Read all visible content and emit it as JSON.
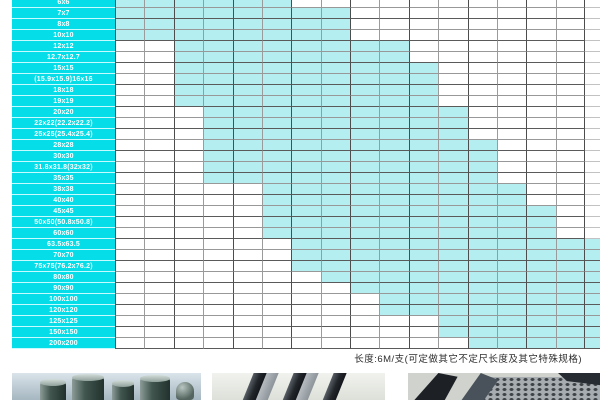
{
  "chart_data": {
    "type": "table",
    "title_visible": false,
    "columns_visible": 16,
    "partial_right_column": true,
    "legend": "cyan cell = size available, white cell = not available; column headers cropped out of view",
    "rows": [
      {
        "label": "6x6",
        "from": 1,
        "to": 6
      },
      {
        "label": "7x7",
        "from": 1,
        "to": 8
      },
      {
        "label": "8x8",
        "from": 1,
        "to": 8
      },
      {
        "label": "10x10",
        "from": 1,
        "to": 8
      },
      {
        "label": "12x12",
        "from": 3,
        "to": 10
      },
      {
        "label": "12.7x12.7",
        "from": 3,
        "to": 10
      },
      {
        "label": "15x15",
        "from": 3,
        "to": 11
      },
      {
        "label": "(15.9x15.9)16x16",
        "from": 3,
        "to": 11
      },
      {
        "label": "18x18",
        "from": 3,
        "to": 11
      },
      {
        "label": "19x19",
        "from": 3,
        "to": 11
      },
      {
        "label": "20x20",
        "from": 4,
        "to": 12
      },
      {
        "label": "22x22(22.2x22.2)",
        "from": 4,
        "to": 12
      },
      {
        "label": "25x25(25.4x25.4)",
        "from": 4,
        "to": 12
      },
      {
        "label": "28x28",
        "from": 4,
        "to": 13
      },
      {
        "label": "30x30",
        "from": 4,
        "to": 13
      },
      {
        "label": "31.8x31.8(32x32)",
        "from": 4,
        "to": 13
      },
      {
        "label": "35x35",
        "from": 4,
        "to": 13
      },
      {
        "label": "38x38",
        "from": 6,
        "to": 14
      },
      {
        "label": "40x40",
        "from": 6,
        "to": 14
      },
      {
        "label": "45x45",
        "from": 6,
        "to": 15
      },
      {
        "label": "50x50(50.8x50.8)",
        "from": 6,
        "to": 15
      },
      {
        "label": "60x60",
        "from": 6,
        "to": 15
      },
      {
        "label": "63.5x63.5",
        "from": 7,
        "to": 17
      },
      {
        "label": "70x70",
        "from": 7,
        "to": 17
      },
      {
        "label": "75x75(76.2x76.2)",
        "from": 7,
        "to": 17
      },
      {
        "label": "80x80",
        "from": 8,
        "to": 17
      },
      {
        "label": "90x90",
        "from": 9,
        "to": 17
      },
      {
        "label": "100x100",
        "from": 10,
        "to": 17
      },
      {
        "label": "120x120",
        "from": 10,
        "to": 17
      },
      {
        "label": "125x125",
        "from": 12,
        "to": 17
      },
      {
        "label": "150x150",
        "from": 12,
        "to": 17
      },
      {
        "label": "200x200",
        "from": 13,
        "to": 17
      }
    ]
  },
  "footnote": "长度:6M/支(可定做其它不定尺长度及其它特殊规格)",
  "colors": {
    "label_bg": "#05dde8",
    "cell_fill": "#b4eef1",
    "cell_empty": "#ffffff",
    "grid_dark": "#4d4d4d",
    "grid_light": "#9b9b9b",
    "row_line_dark": "#5a5a5a",
    "row_line_light": "#989898",
    "sliver_line": "#c2c2c2"
  },
  "photos": {
    "left": "steel-round-bars-photo",
    "middle": "steel-flat-bars-photo",
    "right": "steel-angle-and-perforated-photo"
  }
}
